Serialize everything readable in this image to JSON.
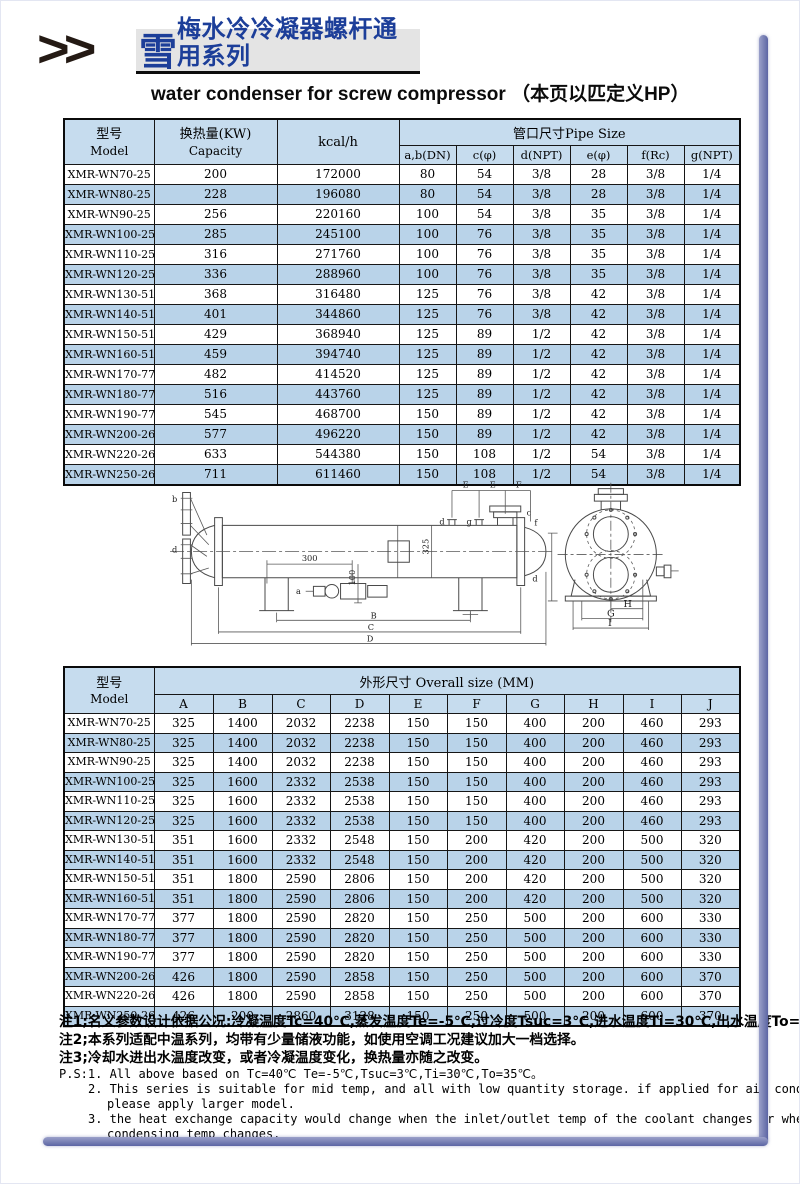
{
  "header": {
    "chevrons": ">>",
    "brand_char": "雪",
    "title_cn": "梅水冷冷凝器螺杆通用系列",
    "subtitle_en": "water condenser for screw compressor （本页以匹定义HP）"
  },
  "capacity_table": {
    "model_label_cn": "型号",
    "model_label_en": "Model",
    "capacity_label_cn": "换热量(KW)",
    "capacity_label_en": "Capacity",
    "kcal_label": "kcal/h",
    "pipe_group_label": "管口尺寸Pipe Size",
    "pipe_columns": [
      "a,b(DN)",
      "c(φ)",
      "d(NPT)",
      "e(φ)",
      "f(Rc)",
      "g(NPT)"
    ],
    "rows": [
      [
        "XMR-WN70-25",
        "200",
        "172000",
        "80",
        "54",
        "3/8",
        "28",
        "3/8",
        "1/4"
      ],
      [
        "XMR-WN80-25",
        "228",
        "196080",
        "80",
        "54",
        "3/8",
        "28",
        "3/8",
        "1/4"
      ],
      [
        "XMR-WN90-25",
        "256",
        "220160",
        "100",
        "54",
        "3/8",
        "35",
        "3/8",
        "1/4"
      ],
      [
        "XMR-WN100-25",
        "285",
        "245100",
        "100",
        "76",
        "3/8",
        "35",
        "3/8",
        "1/4"
      ],
      [
        "XMR-WN110-25",
        "316",
        "271760",
        "100",
        "76",
        "3/8",
        "35",
        "3/8",
        "1/4"
      ],
      [
        "XMR-WN120-25",
        "336",
        "288960",
        "100",
        "76",
        "3/8",
        "35",
        "3/8",
        "1/4"
      ],
      [
        "XMR-WN130-51",
        "368",
        "316480",
        "125",
        "76",
        "3/8",
        "42",
        "3/8",
        "1/4"
      ],
      [
        "XMR-WN140-51",
        "401",
        "344860",
        "125",
        "76",
        "3/8",
        "42",
        "3/8",
        "1/4"
      ],
      [
        "XMR-WN150-51",
        "429",
        "368940",
        "125",
        "89",
        "1/2",
        "42",
        "3/8",
        "1/4"
      ],
      [
        "XMR-WN160-51",
        "459",
        "394740",
        "125",
        "89",
        "1/2",
        "42",
        "3/8",
        "1/4"
      ],
      [
        "XMR-WN170-77",
        "482",
        "414520",
        "125",
        "89",
        "1/2",
        "42",
        "3/8",
        "1/4"
      ],
      [
        "XMR-WN180-77",
        "516",
        "443760",
        "125",
        "89",
        "1/2",
        "42",
        "3/8",
        "1/4"
      ],
      [
        "XMR-WN190-77",
        "545",
        "468700",
        "150",
        "89",
        "1/2",
        "42",
        "3/8",
        "1/4"
      ],
      [
        "XMR-WN200-26",
        "577",
        "496220",
        "150",
        "89",
        "1/2",
        "42",
        "3/8",
        "1/4"
      ],
      [
        "XMR-WN220-26",
        "633",
        "544380",
        "150",
        "108",
        "1/2",
        "54",
        "3/8",
        "1/4"
      ],
      [
        "XMR-WN250-26",
        "711",
        "611460",
        "150",
        "108",
        "1/2",
        "54",
        "3/8",
        "1/4"
      ]
    ]
  },
  "diagram": {
    "side_labels": {
      "b": "b",
      "d_left": "d",
      "a": "a",
      "d_top": "d",
      "g_top": "g",
      "c_top": "c",
      "f_right": "f",
      "d_right": "d",
      "dim_300": "300",
      "dim_100": "100",
      "dim_325": "325",
      "B": "B",
      "C": "C",
      "D": "D",
      "E1": "E",
      "E2": "E",
      "F": "F"
    },
    "end_labels": {
      "H": "H",
      "G": "G",
      "I": "I"
    }
  },
  "overall_table": {
    "model_label_cn": "型号",
    "model_label_en": "Model",
    "group_label": "外形尺寸 Overall size (MM)",
    "columns": [
      "A",
      "B",
      "C",
      "D",
      "E",
      "F",
      "G",
      "H",
      "I",
      "J"
    ],
    "rows": [
      [
        "XMR-WN70-25",
        "325",
        "1400",
        "2032",
        "2238",
        "150",
        "150",
        "400",
        "200",
        "460",
        "293"
      ],
      [
        "XMR-WN80-25",
        "325",
        "1400",
        "2032",
        "2238",
        "150",
        "150",
        "400",
        "200",
        "460",
        "293"
      ],
      [
        "XMR-WN90-25",
        "325",
        "1400",
        "2032",
        "2238",
        "150",
        "150",
        "400",
        "200",
        "460",
        "293"
      ],
      [
        "XMR-WN100-25",
        "325",
        "1600",
        "2332",
        "2538",
        "150",
        "150",
        "400",
        "200",
        "460",
        "293"
      ],
      [
        "XMR-WN110-25",
        "325",
        "1600",
        "2332",
        "2538",
        "150",
        "150",
        "400",
        "200",
        "460",
        "293"
      ],
      [
        "XMR-WN120-25",
        "325",
        "1600",
        "2332",
        "2538",
        "150",
        "150",
        "400",
        "200",
        "460",
        "293"
      ],
      [
        "XMR-WN130-51",
        "351",
        "1600",
        "2332",
        "2548",
        "150",
        "200",
        "420",
        "200",
        "500",
        "320"
      ],
      [
        "XMR-WN140-51",
        "351",
        "1600",
        "2332",
        "2548",
        "150",
        "200",
        "420",
        "200",
        "500",
        "320"
      ],
      [
        "XMR-WN150-51",
        "351",
        "1800",
        "2590",
        "2806",
        "150",
        "200",
        "420",
        "200",
        "500",
        "320"
      ],
      [
        "XMR-WN160-51",
        "351",
        "1800",
        "2590",
        "2806",
        "150",
        "200",
        "420",
        "200",
        "500",
        "320"
      ],
      [
        "XMR-WN170-77",
        "377",
        "1800",
        "2590",
        "2820",
        "150",
        "250",
        "500",
        "200",
        "600",
        "330"
      ],
      [
        "XMR-WN180-77",
        "377",
        "1800",
        "2590",
        "2820",
        "150",
        "250",
        "500",
        "200",
        "600",
        "330"
      ],
      [
        "XMR-WN190-77",
        "377",
        "1800",
        "2590",
        "2820",
        "150",
        "250",
        "500",
        "200",
        "600",
        "330"
      ],
      [
        "XMR-WN200-26",
        "426",
        "1800",
        "2590",
        "2858",
        "150",
        "250",
        "500",
        "200",
        "600",
        "370"
      ],
      [
        "XMR-WN220-26",
        "426",
        "1800",
        "2590",
        "2858",
        "150",
        "250",
        "500",
        "200",
        "600",
        "370"
      ],
      [
        "XMR-WN250-26",
        "426",
        "200",
        "2860",
        "3128",
        "150",
        "250",
        "500",
        "200",
        "600",
        "370"
      ]
    ]
  },
  "notes": {
    "cn": [
      "注1;名义参数设计依据公况:冷凝温度Tc=40℃,蒸发温度Te=-5℃,过冷度Tsuc=3℃,进水温度Ti=30℃,出水温度To=35℃。",
      "注2;本系列适配中温系列，均带有少量储液功能，如使用空调工况建议加大一档选择。",
      "注3;冷却水进出水温度改变，或者冷凝温度变化，换热量亦随之改变。"
    ],
    "en": [
      "P.S:1. All above based on Tc=40℃ Te=-5℃,Tsuc=3℃,Ti=30℃,To=35℃。",
      "2. This series is suitable for mid temp, and all with low quantity storage. if applied for air conditioning,",
      "please apply larger model.",
      "3. the heat exchange capacity would change when the inlet/outlet temp of the coolant changes or when the",
      "condensing temp changes."
    ]
  },
  "colors": {
    "table_header_bg": "#c6dcee",
    "row_alt_bg": "#b9d3e9",
    "title_blue": "#1c3e99",
    "frame_purple": "#6a72ab"
  }
}
